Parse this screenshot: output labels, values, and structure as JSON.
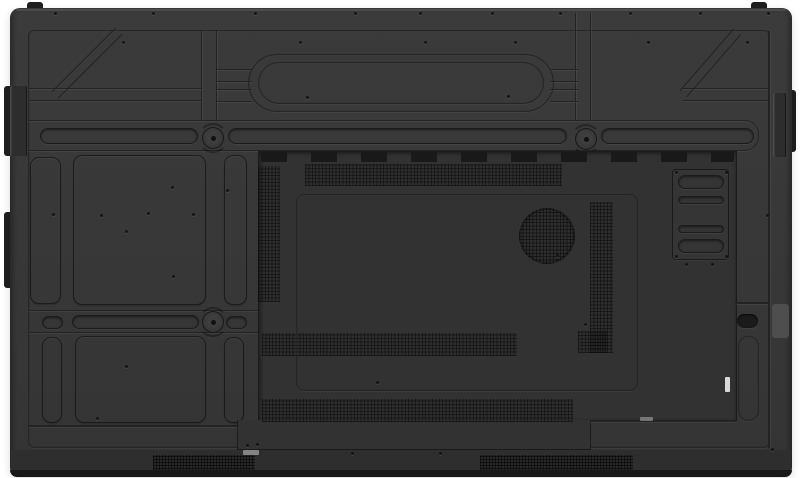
{
  "scene": {
    "label": "rear-view-of-flat-panel-display",
    "width": 800,
    "height": 478
  },
  "colors": {
    "background": "#ffffff",
    "panel": "#383838",
    "module": "#323232",
    "inner_line": "#262626",
    "groove": "#232323",
    "slot_dark": "#1b1b1b",
    "tab": "#1f1f1f",
    "bottom_band": "#2e2e2e",
    "bottom_strip": "#181818",
    "handle_indent": "#525252",
    "label_light": "#9a9a9a",
    "connector_white": "#d9d9d9",
    "screw": "#151515"
  },
  "elements": [
    {
      "name": "top-mount-tab-left",
      "cls": "tab",
      "x": 27,
      "y": 2,
      "w": 16,
      "h": 8,
      "r": [
        3,
        3,
        0,
        0
      ]
    },
    {
      "name": "top-mount-tab-right",
      "cls": "tab",
      "x": 751,
      "y": 2,
      "w": 16,
      "h": 8,
      "r": [
        3,
        3,
        0,
        0
      ]
    },
    {
      "name": "side-tab-left-upper",
      "cls": "tab",
      "x": 4,
      "y": 86,
      "w": 8,
      "h": 70,
      "r": [
        3,
        0,
        0,
        3
      ]
    },
    {
      "name": "side-tab-left-lower",
      "cls": "tab",
      "x": 4,
      "y": 212,
      "w": 8,
      "h": 76,
      "r": [
        3,
        0,
        0,
        3
      ]
    },
    {
      "name": "side-tab-right-upper",
      "cls": "tab",
      "x": 788,
      "y": 90,
      "w": 8,
      "h": 62,
      "r": [
        0,
        3,
        3,
        0
      ]
    },
    {
      "name": "rear-panel-body",
      "cls": "panel-base",
      "x": 10,
      "y": 8,
      "w": 782,
      "h": 469,
      "r": 10
    },
    {
      "name": "panel-top-highlight",
      "cls": "flat",
      "x": 16,
      "y": 9,
      "w": 770,
      "h": 2,
      "fill": "rgba(255,255,255,0.09)",
      "r": 2
    },
    {
      "name": "left-edge-rail",
      "cls": "rail",
      "x": 10,
      "y": 86,
      "w": 17,
      "h": 70
    },
    {
      "name": "right-edge-rail",
      "cls": "rail",
      "x": 773,
      "y": 93,
      "w": 13,
      "h": 64
    },
    {
      "name": "back-face-outline",
      "cls": "frame",
      "x": 28,
      "y": 30,
      "w": 742,
      "h": 418,
      "r": 6
    },
    {
      "name": "vertical-rib-left",
      "cls": "groove-v",
      "x": 201,
      "y": 31,
      "w": 16,
      "h": 90
    },
    {
      "name": "vertical-rib-right",
      "cls": "groove-v",
      "x": 575,
      "y": 13,
      "w": 16,
      "h": 108
    },
    {
      "name": "horizontal-groove-left",
      "cls": "groove-h",
      "x": 29,
      "y": 88,
      "w": 173,
      "h": 13
    },
    {
      "name": "horizontal-groove-right",
      "cls": "groove-h",
      "x": 683,
      "y": 88,
      "w": 87,
      "h": 13
    },
    {
      "name": "diagonal-groove-left",
      "cls": "diag",
      "x": 42,
      "y": 58,
      "w": 90,
      "h": 10,
      "rot": -45
    },
    {
      "name": "diagonal-groove-right",
      "cls": "diag",
      "x": 669,
      "y": 58,
      "w": 82,
      "h": 10,
      "rot": -49
    },
    {
      "name": "stadium-stub-left-upper",
      "cls": "groove-h",
      "x": 216,
      "y": 69,
      "w": 36,
      "h": 13
    },
    {
      "name": "stadium-stub-left-lower",
      "cls": "groove-h",
      "x": 216,
      "y": 89,
      "w": 36,
      "h": 13
    },
    {
      "name": "stadium-stub-right-upper",
      "cls": "groove-h",
      "x": 550,
      "y": 69,
      "w": 28,
      "h": 13
    },
    {
      "name": "stadium-stub-right-lower",
      "cls": "groove-h",
      "x": 550,
      "y": 89,
      "w": 28,
      "h": 13
    },
    {
      "name": "handle-recess-outer",
      "cls": "frame",
      "x": 248,
      "y": 54,
      "w": 306,
      "h": 58,
      "r": 29
    },
    {
      "name": "handle-recess-inner",
      "cls": "frame",
      "x": 258,
      "y": 62,
      "w": 286,
      "h": 42,
      "r": 21
    },
    {
      "name": "mount-bar-upper",
      "cls": "band",
      "x": 28,
      "y": 120,
      "w": 731,
      "h": 31,
      "r": [
        0,
        14,
        14,
        0
      ]
    },
    {
      "name": "mount-bar-lower",
      "cls": "band",
      "x": 28,
      "y": 310,
      "w": 231,
      "h": 23
    },
    {
      "name": "panel-section-r1-a",
      "cls": "section",
      "x": 30,
      "y": 157,
      "w": 31,
      "h": 147
    },
    {
      "name": "panel-section-r1-b",
      "cls": "section",
      "x": 73,
      "y": 155,
      "w": 133,
      "h": 150
    },
    {
      "name": "panel-section-r1-c",
      "cls": "section",
      "x": 224,
      "y": 155,
      "w": 23,
      "h": 150
    },
    {
      "name": "panel-section-r2-a",
      "cls": "section",
      "x": 42,
      "y": 337,
      "w": 20,
      "h": 86
    },
    {
      "name": "panel-section-r2-b",
      "cls": "section",
      "x": 75,
      "y": 336,
      "w": 131,
      "h": 87
    },
    {
      "name": "panel-section-r2-c",
      "cls": "section",
      "x": 224,
      "y": 337,
      "w": 20,
      "h": 86
    },
    {
      "name": "left-bottom-groove",
      "cls": "hline",
      "x": 28,
      "y": 425,
      "w": 231,
      "h": 2
    },
    {
      "name": "mount-slot-upper-left",
      "cls": "pill",
      "x": 40,
      "y": 128,
      "w": 158,
      "h": 16
    },
    {
      "name": "mount-slot-upper-center",
      "cls": "pill",
      "x": 228,
      "y": 128,
      "w": 339,
      "h": 16
    },
    {
      "name": "mount-slot-upper-right",
      "cls": "pill",
      "x": 601,
      "y": 128,
      "w": 153,
      "h": 16
    },
    {
      "name": "mount-slot-lower-small-left",
      "cls": "pill",
      "x": 42,
      "y": 316,
      "w": 21,
      "h": 13
    },
    {
      "name": "mount-slot-lower-long",
      "cls": "pill",
      "x": 72,
      "y": 315,
      "w": 127,
      "h": 14
    },
    {
      "name": "mount-slot-lower-small-right",
      "cls": "pill",
      "x": 226,
      "y": 316,
      "w": 21,
      "h": 13
    },
    {
      "name": "vesa-mount-top-left",
      "cls": "vesa",
      "x": 202,
      "y": 127,
      "w": 22,
      "h": 22
    },
    {
      "name": "vesa-mount-top-right",
      "cls": "vesa",
      "x": 575,
      "y": 128,
      "w": 22,
      "h": 22
    },
    {
      "name": "vesa-mount-bottom-left",
      "cls": "vesa",
      "x": 202,
      "y": 311,
      "w": 22,
      "h": 22
    },
    {
      "name": "io-module-recess",
      "cls": "module-rect mod-main",
      "x": 258,
      "y": 151,
      "w": 479,
      "h": 270
    },
    {
      "name": "io-module-recess-lower",
      "cls": "module-rect mod-ext",
      "x": 237,
      "y": 420,
      "w": 354,
      "h": 30
    },
    {
      "name": "module-notch-edge",
      "cls": "hline",
      "x": 590,
      "y": 420,
      "w": 147,
      "h": 2
    },
    {
      "name": "module-vent-slot-row",
      "cls": "slots",
      "x": 261,
      "y": 152,
      "w": 473,
      "h": 10
    },
    {
      "name": "vent-grille-top",
      "cls": "vent",
      "x": 305,
      "y": 164,
      "w": 257,
      "h": 22
    },
    {
      "name": "vent-grille-left-column",
      "cls": "vent",
      "x": 258,
      "y": 166,
      "w": 22,
      "h": 136
    },
    {
      "name": "vent-grille-right-column",
      "cls": "vent",
      "x": 590,
      "y": 202,
      "w": 23,
      "h": 151
    },
    {
      "name": "vent-grille-mid-left",
      "cls": "vent",
      "x": 262,
      "y": 333,
      "w": 255,
      "h": 23
    },
    {
      "name": "vent-grille-mid-patch",
      "cls": "vent",
      "x": 578,
      "y": 331,
      "w": 30,
      "h": 22
    },
    {
      "name": "vent-grille-lower",
      "cls": "vent",
      "x": 262,
      "y": 399,
      "w": 311,
      "h": 23
    },
    {
      "name": "module-inner-plate",
      "cls": "frame",
      "x": 296,
      "y": 194,
      "w": 342,
      "h": 197,
      "r": 8
    },
    {
      "name": "speaker-grille-circle",
      "cls": "vent vent-circle",
      "x": 519,
      "y": 208,
      "w": 56,
      "h": 56
    },
    {
      "name": "ops-bracket-plate",
      "cls": "plate",
      "x": 672,
      "y": 169,
      "w": 57,
      "h": 91
    },
    {
      "name": "ops-bracket-slot-1",
      "cls": "pill",
      "x": 678,
      "y": 175,
      "w": 46,
      "h": 14
    },
    {
      "name": "ops-bracket-slot-2",
      "cls": "pill",
      "x": 678,
      "y": 196,
      "w": 46,
      "h": 8
    },
    {
      "name": "ops-bracket-slot-3",
      "cls": "pill",
      "x": 678,
      "y": 225,
      "w": 46,
      "h": 8
    },
    {
      "name": "ops-bracket-slot-4",
      "cls": "pill",
      "x": 678,
      "y": 239,
      "w": 46,
      "h": 14
    },
    {
      "name": "module-connector-label",
      "cls": "flat",
      "x": 640,
      "y": 417,
      "w": 13,
      "h": 4,
      "fill": "#8f8f8f",
      "op": 0.75,
      "r": 1
    },
    {
      "name": "power-switch-connector",
      "cls": "flat",
      "x": 725,
      "y": 377,
      "w": 5,
      "h": 15,
      "fill": "connector_white",
      "r": 1
    },
    {
      "name": "right-panel-seam",
      "cls": "vline",
      "x": 768,
      "y": 31,
      "w": 2,
      "h": 417
    },
    {
      "name": "right-handle-groove",
      "cls": "hline",
      "x": 735,
      "y": 302,
      "w": 33,
      "h": 2
    },
    {
      "name": "handle-hole",
      "cls": "pill-dark",
      "x": 737,
      "y": 314,
      "w": 21,
      "h": 14
    },
    {
      "name": "handle-recess-vertical",
      "cls": "frame",
      "x": 738,
      "y": 336,
      "w": 21,
      "h": 85,
      "r": 10
    },
    {
      "name": "side-handle-indent",
      "cls": "flat",
      "x": 772,
      "y": 304,
      "w": 17,
      "h": 34,
      "fill": "handle_indent",
      "r": 3,
      "op": 0.85
    },
    {
      "name": "bottom-band",
      "cls": "flat",
      "x": 11,
      "y": 450,
      "w": 780,
      "h": 21,
      "fill": "bottom_band"
    },
    {
      "name": "speaker-grille-bottom-left",
      "cls": "vent vent-dense",
      "x": 153,
      "y": 455,
      "w": 102,
      "h": 17
    },
    {
      "name": "speaker-grille-bottom-right",
      "cls": "vent vent-dense",
      "x": 480,
      "y": 455,
      "w": 153,
      "h": 17
    },
    {
      "name": "serial-label",
      "cls": "flat",
      "x": 243,
      "y": 450,
      "w": 16,
      "h": 5,
      "fill": "label_light",
      "op": 0.8,
      "r": 1
    },
    {
      "name": "bottom-edge-strip",
      "cls": "flat",
      "x": 10,
      "y": 470,
      "w": 782,
      "h": 7,
      "fill": "bottom_strip",
      "r": [
        0,
        0,
        10,
        10
      ]
    }
  ],
  "screws": [
    [
      55,
      13
    ],
    [
      153,
      13
    ],
    [
      255,
      13
    ],
    [
      355,
      13
    ],
    [
      420,
      13
    ],
    [
      492,
      13
    ],
    [
      560,
      13
    ],
    [
      630,
      13
    ],
    [
      700,
      13
    ],
    [
      768,
      13
    ],
    [
      123,
      42
    ],
    [
      300,
      42
    ],
    [
      425,
      42
    ],
    [
      515,
      42
    ],
    [
      648,
      42
    ],
    [
      747,
      42
    ],
    [
      307,
      97
    ],
    [
      508,
      96
    ],
    [
      53,
      214
    ],
    [
      101,
      215
    ],
    [
      126,
      231
    ],
    [
      148,
      213
    ],
    [
      172,
      187
    ],
    [
      193,
      214
    ],
    [
      173,
      276
    ],
    [
      126,
      366
    ],
    [
      227,
      190
    ],
    [
      97,
      418
    ],
    [
      557,
      255
    ],
    [
      585,
      324
    ],
    [
      377,
      382
    ],
    [
      676,
      172
    ],
    [
      726,
      172
    ],
    [
      676,
      256
    ],
    [
      726,
      256
    ],
    [
      686,
      264
    ],
    [
      712,
      264
    ],
    [
      247,
      445
    ],
    [
      257,
      444
    ],
    [
      352,
      453
    ],
    [
      440,
      453
    ],
    [
      767,
      215
    ],
    [
      772,
      449
    ]
  ]
}
